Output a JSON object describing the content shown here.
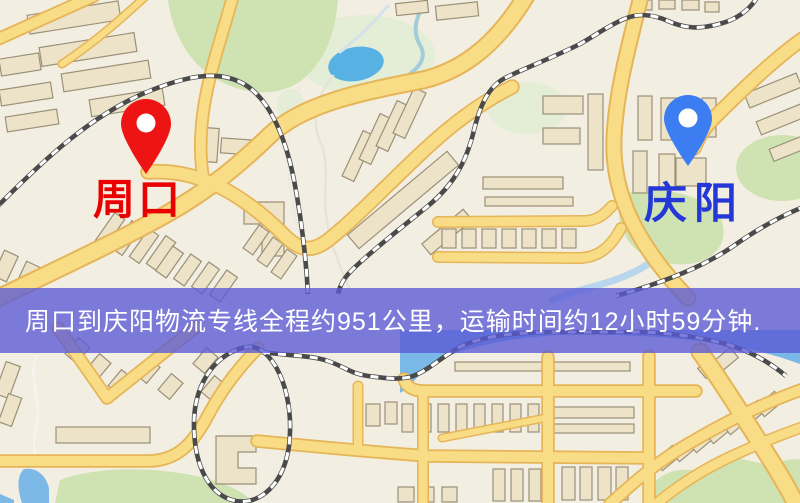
{
  "map": {
    "markers": {
      "origin": {
        "name": "周口",
        "pin_color": "#ee1414",
        "label_color": "#ea0000"
      },
      "destination": {
        "name": "庆阳",
        "pin_color": "#3c7ef2",
        "label_color": "#2438d8"
      }
    },
    "banner": {
      "text": "周口到庆阳物流专线全程约951公里，运输时间约12小时59分钟.",
      "background_color": "#5a5ad6",
      "text_color": "#ffffff",
      "route": {
        "origin": "周口",
        "destination": "庆阳",
        "service": "物流专线",
        "distance_km": 951,
        "duration": "12小时59分钟"
      }
    },
    "palette": {
      "background": "#f3eee2",
      "road": "#f8dc86",
      "road_casing": "#e6b557",
      "railway": "#4a4a4a",
      "water": "#7ab8e7",
      "park": "#cfe3b2",
      "building": "#ece3c9"
    }
  }
}
